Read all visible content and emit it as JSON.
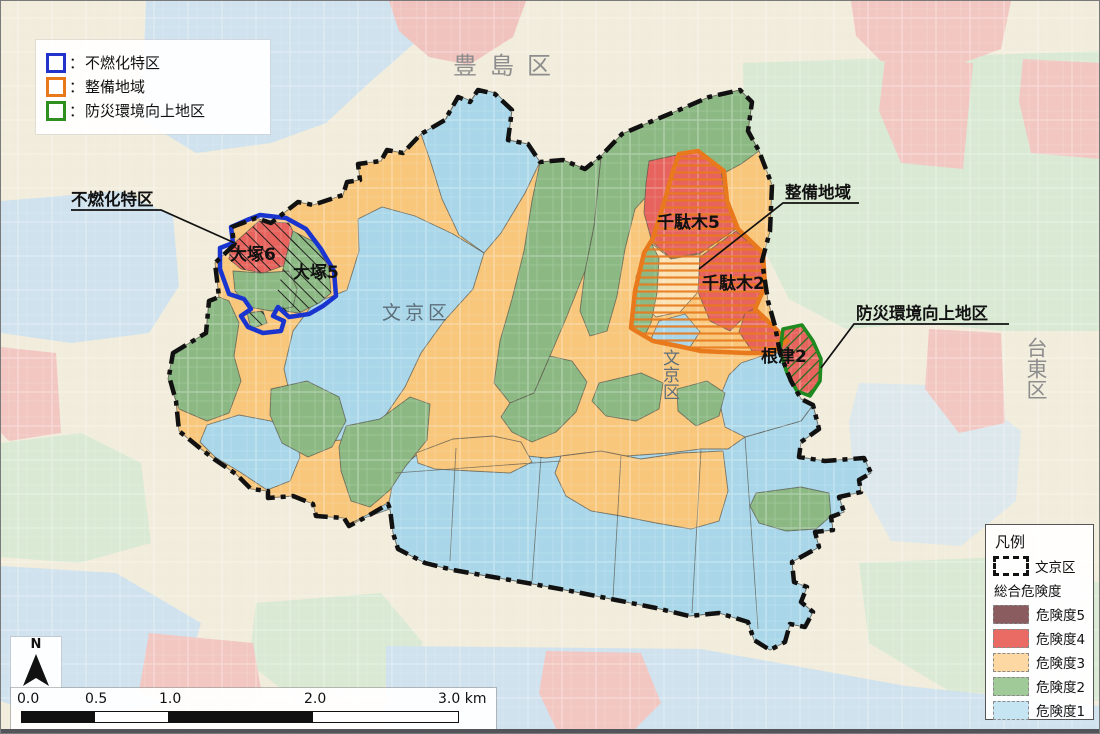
{
  "legend_overlay": {
    "separator": "：",
    "items": [
      {
        "name": "funenka",
        "label": "不燃化特区",
        "color": "#2233cc"
      },
      {
        "name": "seibi",
        "label": "整備地域",
        "color": "#e87818"
      },
      {
        "name": "bousai",
        "label": "防災環境向上地区",
        "color": "#2f8f1f"
      }
    ]
  },
  "legend_panel": {
    "title": "凡例",
    "boundary_label": "文京区",
    "subtitle": "総合危険度",
    "items": [
      {
        "label": "危険度5",
        "color": "#8a5c60"
      },
      {
        "label": "危険度4",
        "color": "#ea6b63"
      },
      {
        "label": "危険度3",
        "color": "#fdd8a2"
      },
      {
        "label": "危険度2",
        "color": "#a0ca98"
      },
      {
        "label": "危険度1",
        "color": "#c4e5f1"
      }
    ]
  },
  "scalebar": {
    "ticks": [
      "0.0",
      "0.5",
      "1.0",
      "2.0",
      "3.0 km"
    ]
  },
  "north": {
    "label": "N"
  },
  "map_labels": {
    "callout_funenka": "不燃化特区",
    "callout_seibi": "整備地域",
    "callout_bousai": "防災環境向上地区",
    "otsuka6": "大塚6",
    "otsuka5": "大塚5",
    "sendagi5": "千駄木5",
    "sendagi2": "千駄木2",
    "nezu2": "根津2",
    "bunkyo_horizontal": "文京区",
    "bunkyo_vertical": "文京区",
    "toshima": "豊島区",
    "taito": "台東区"
  },
  "colors": {
    "risk5": "#8a5c60",
    "risk4": "#ea6b63",
    "risk3": "#fdd8a2",
    "risk2": "#a0ca98",
    "risk1": "#c4e5f1",
    "map_risk4": "#e7635d",
    "map_risk3": "#f8c77c",
    "map_risk2": "#8cb983",
    "map_risk1": "#a9d7e9",
    "map_risk3_light": "#fbe2b5",
    "funenka_outline": "#1a35cf",
    "seibi_outline": "#e8791c",
    "bousai_outline": "#1f8a1f",
    "ward_boundary": "#111111"
  }
}
